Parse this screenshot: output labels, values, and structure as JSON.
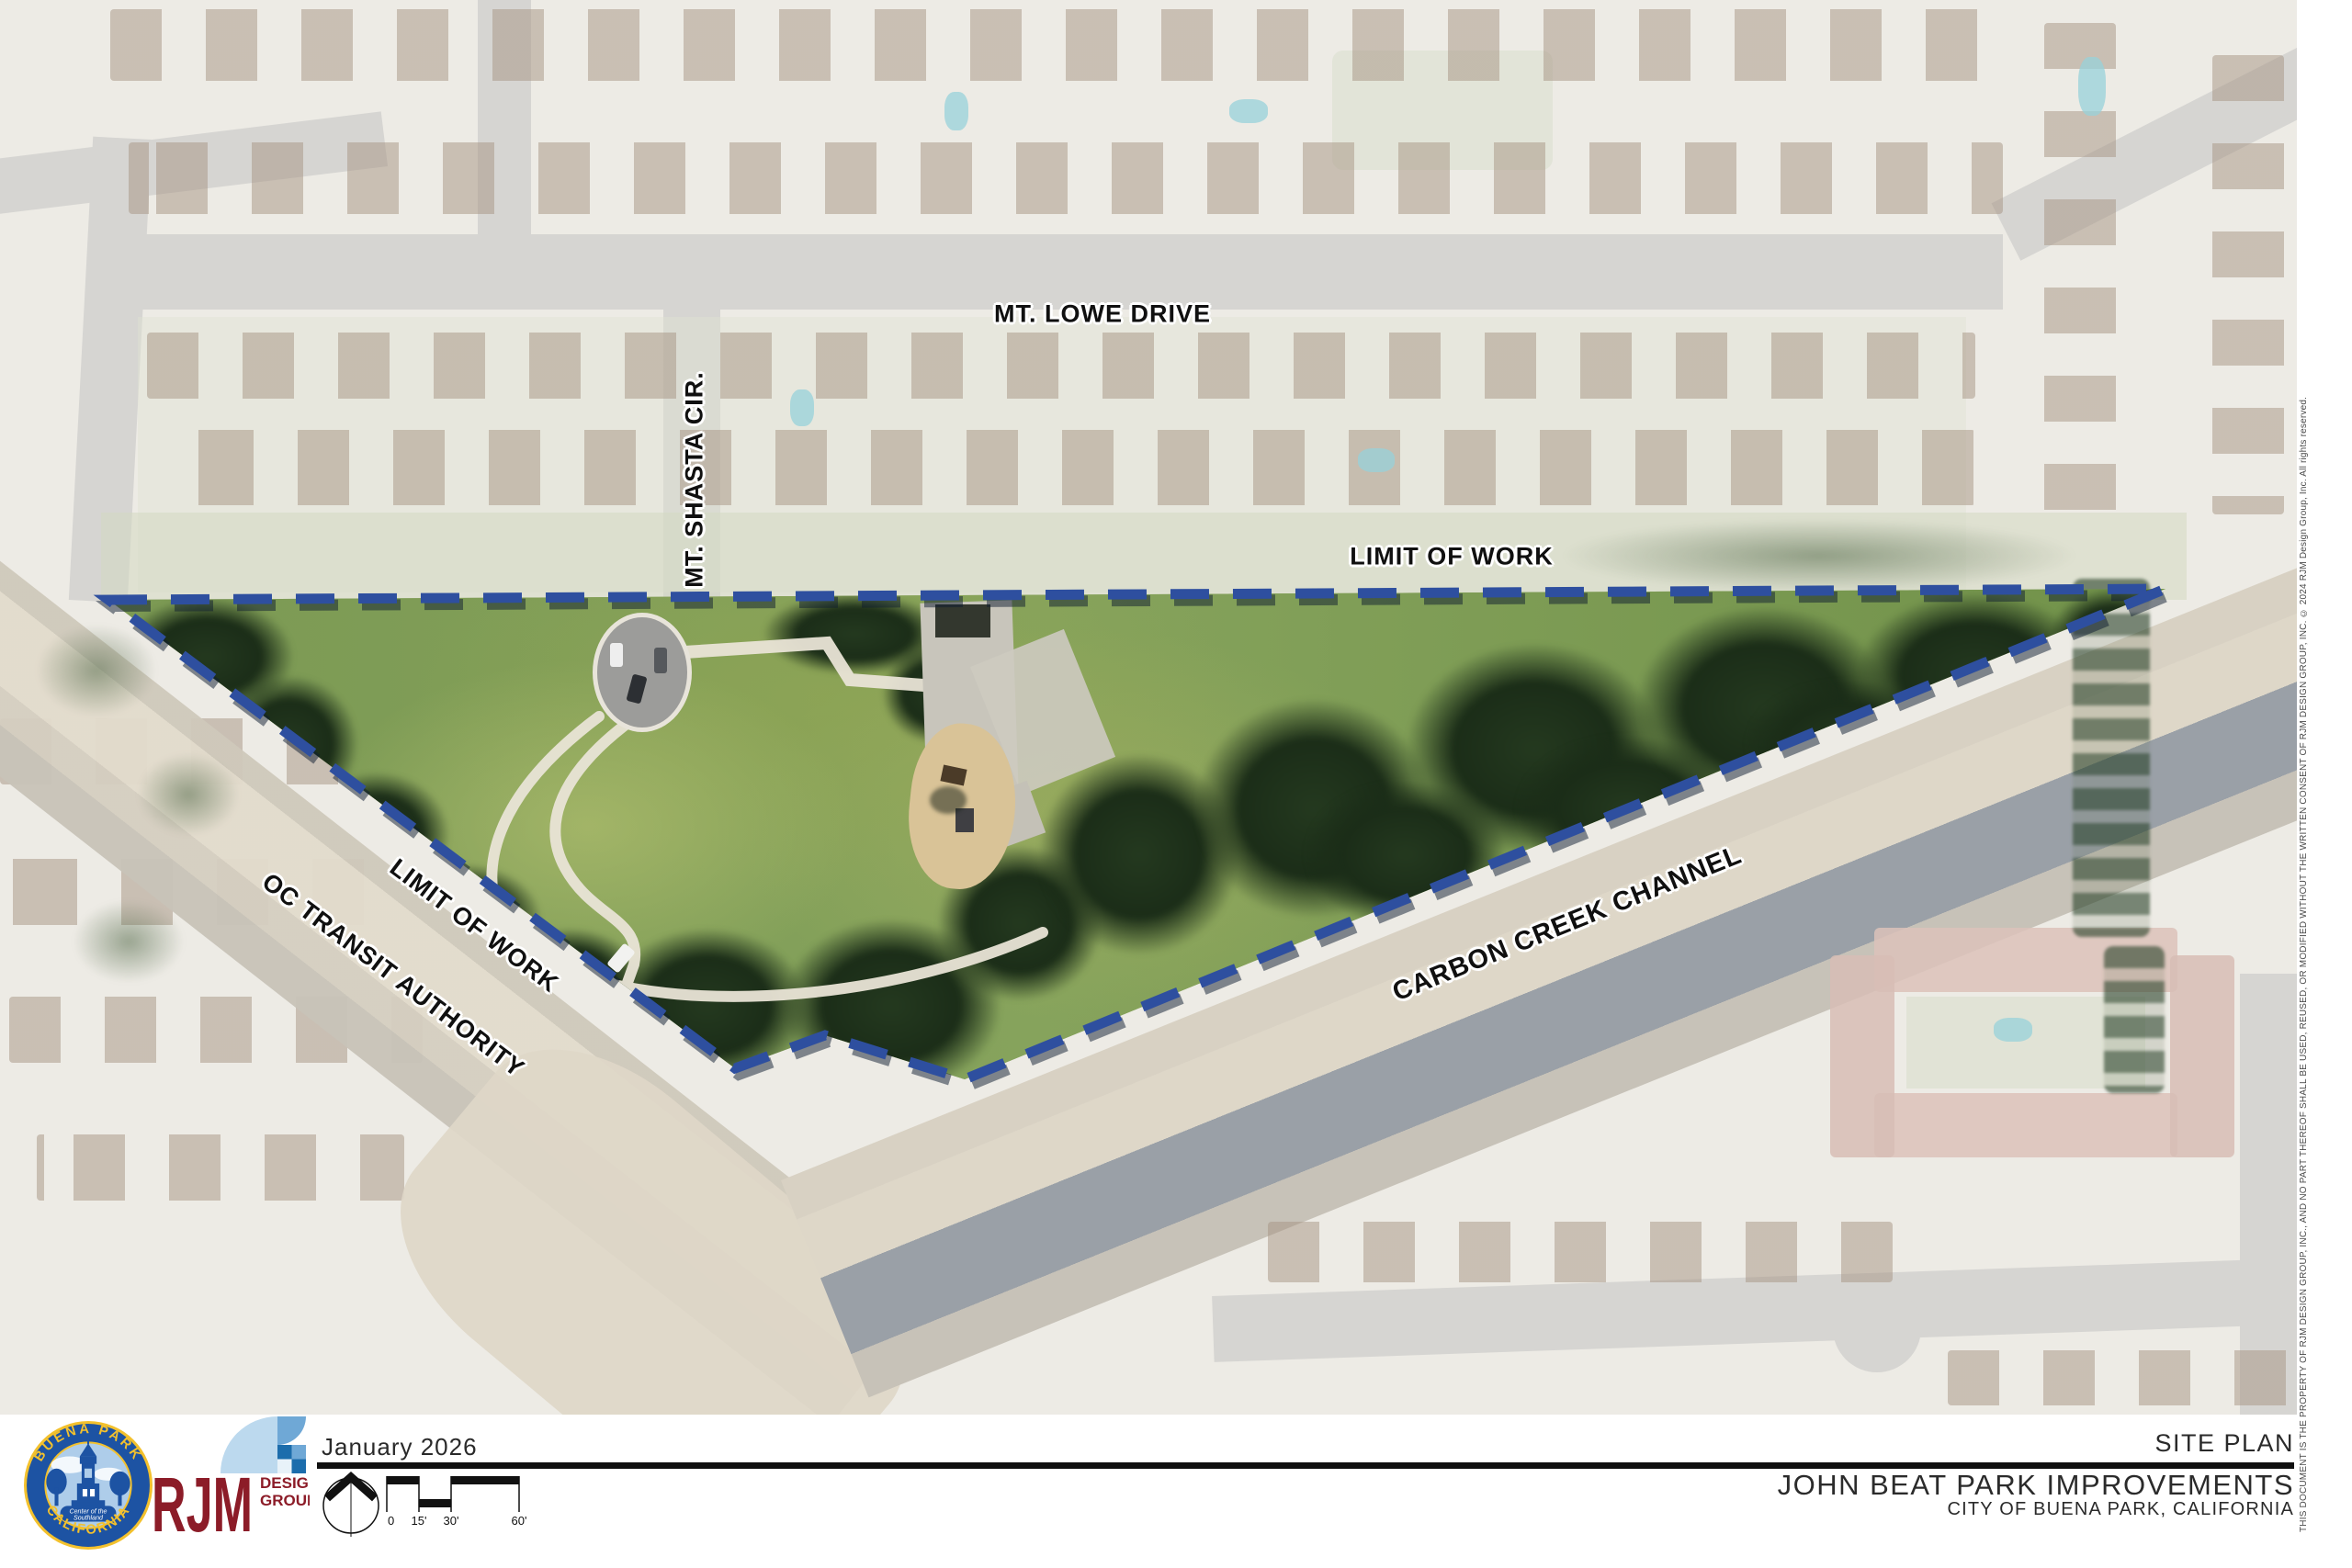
{
  "map": {
    "labels": {
      "mt_lowe": "MT. LOWE DRIVE",
      "mt_shasta": "MT. SHASTA CIR.",
      "limit_of_work_top": "LIMIT OF WORK",
      "limit_of_work_left": "LIMIT OF WORK",
      "oc_transit": "OC TRANSIT AUTHORITY",
      "carbon_creek": "CARBON CREEK CHANNEL"
    },
    "boundary_color": "#2e4f9f"
  },
  "titleblock": {
    "date": "January 2026",
    "sheet_title": "SITE PLAN",
    "project_title": "JOHN BEAT PARK IMPROVEMENTS",
    "project_location": "CITY OF BUENA PARK, CALIFORNIA"
  },
  "scalebar": {
    "labels": [
      "0",
      "15'",
      "30'",
      "60'"
    ]
  },
  "logos": {
    "buena_park": {
      "arc_top": "BUENA PARK",
      "arc_bottom": "CALIFORNIA",
      "banner_line1": "Center of the",
      "banner_line2": "Southland",
      "ring_color": "#1d53a3",
      "text_color": "#f3c12d"
    },
    "rjm": {
      "initials": "RJM",
      "word1": "DESIGN",
      "word2": "GROUP",
      "brand_color": "#8c1c28"
    }
  },
  "disclaimer": "THIS DOCUMENT IS THE PROPERTY OF RJM DESIGN GROUP, INC., AND NO PART THEREOF SHALL BE USED, REUSED, OR MODIFIED WITHOUT THE WRITTEN CONSENT OF RJM DESIGN GROUP, INC.   © 2024 RJM Design Group, Inc.   All rights reserved."
}
